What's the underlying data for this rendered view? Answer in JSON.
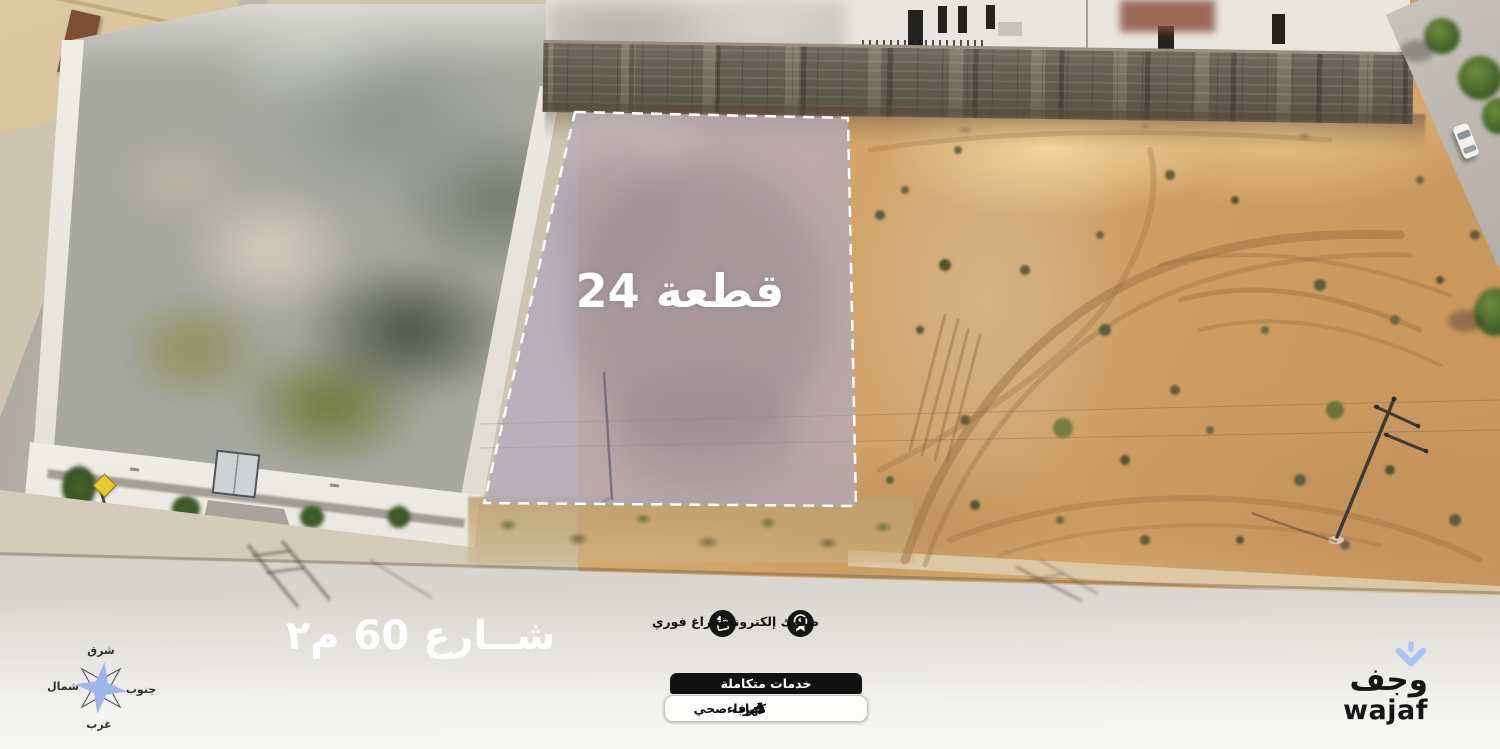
{
  "scene": {
    "type": "aerial-drone-photo",
    "subject": "vacant land plot for sale between residential compounds"
  },
  "plot": {
    "label": "قطعة 24"
  },
  "street": {
    "label": "شــارع 60 م٢"
  },
  "compass": {
    "top": "شرق",
    "left": "شمال",
    "right": "جنوب",
    "bottom": "غرب"
  },
  "features": {
    "instant_transfer": {
      "label": "إفراغ فوري",
      "icon": "document-handover-icon"
    },
    "electronic_deeds": {
      "label": "صكوك إلكترونية",
      "icon": "medal-seal-icon"
    }
  },
  "services": {
    "title": "خدمات متكاملة",
    "water": {
      "label": "مــاء",
      "icon": "water-drop-icon"
    },
    "electricity": {
      "label": "كهرباء",
      "icon": "lightning-bolt-icon"
    },
    "sewage": {
      "label": "صرف صحي",
      "icon": "faucet-icon"
    }
  },
  "brand": {
    "arabic": "وجف",
    "latin": "wajaf"
  },
  "colors": {
    "plot_overlay": "#a79fc6",
    "plot_border": "#ffffff",
    "icon_circle_bg": "#141414",
    "services_bar_bg": "#121212",
    "services_panel_bg": "#fdfdfb",
    "brand_accent": "#a9c4f2",
    "brand_text": "#161616",
    "compass_star": "#9db5e8",
    "overlay_text": "#ffffff"
  }
}
